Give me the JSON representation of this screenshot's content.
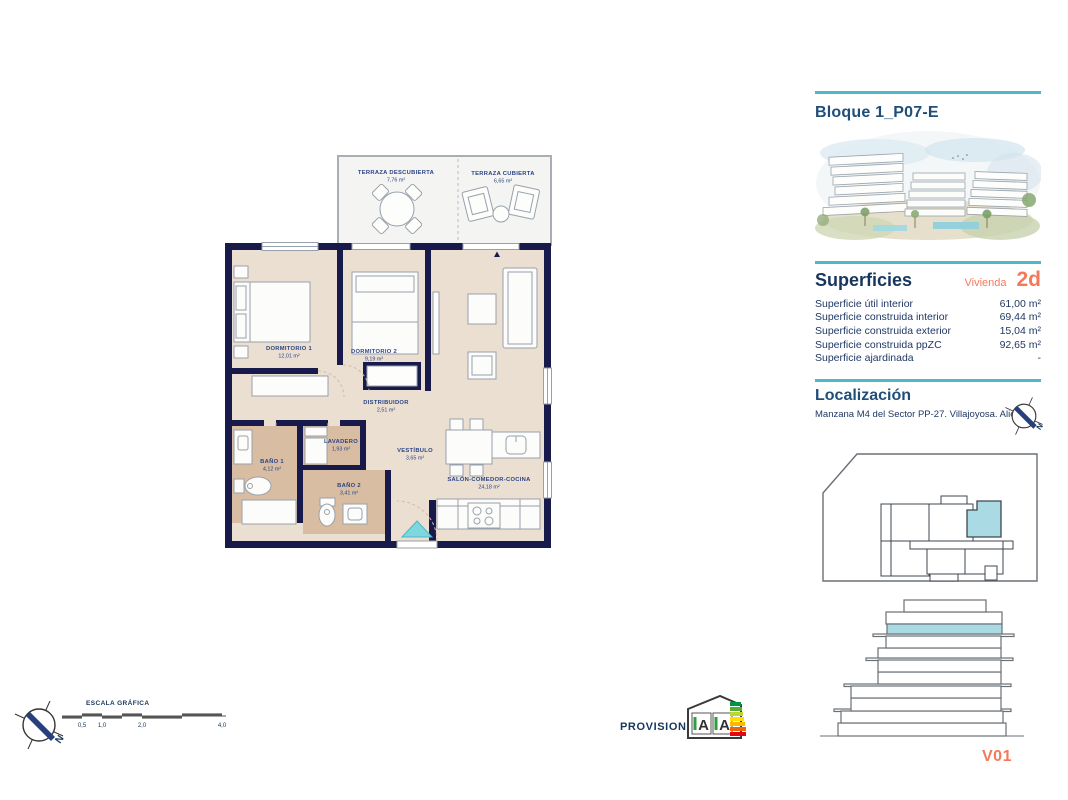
{
  "colors": {
    "teal": "#4cb9c6",
    "orange": "#f4795b",
    "navy_text": "#17365d",
    "wall_navy": "#181a4b",
    "floor_beige": "#ebdfd2",
    "floor_tan": "#d8bda2",
    "highlight_blue": "#aadbe4"
  },
  "header": {
    "title": "Bloque 1_P07-E"
  },
  "superficies": {
    "heading": "Superficies",
    "vivienda_label": "Vivienda",
    "vivienda_value": "2d",
    "rows": [
      {
        "label": "Superficie útil interior",
        "value": "61,00 m²"
      },
      {
        "label": "Superficie construida interior",
        "value": "69,44 m²"
      },
      {
        "label": "Superficie construida exterior",
        "value": "15,04 m²"
      },
      {
        "label": "Superficie construida ppZC",
        "value": "92,65 m²"
      },
      {
        "label": "Superficie ajardinada",
        "value": "-"
      }
    ]
  },
  "localizacion": {
    "heading": "Localización",
    "address": "Manzana M4 del Sector PP-27. Villajoyosa. Alicante"
  },
  "plan": {
    "rooms": [
      {
        "name": "TERRAZA DESCUBIERTA",
        "area": "7,76 m²"
      },
      {
        "name": "TERRAZA CUBIERTA",
        "area": "6,65 m²"
      },
      {
        "name": "DORMITORIO 1",
        "area": "12,01 m²"
      },
      {
        "name": "DORMITORIO 2",
        "area": "9,19 m²"
      },
      {
        "name": "DISTRIBUIDOR",
        "area": "2,51 m²"
      },
      {
        "name": "LAVADERO",
        "area": "1,93 m²"
      },
      {
        "name": "BAÑO 1",
        "area": "4,12 m²"
      },
      {
        "name": "BAÑO 2",
        "area": "3,41 m²"
      },
      {
        "name": "VESTÍBULO",
        "area": "3,65 m²"
      },
      {
        "name": "SALÓN-COMEDOR-COCINA",
        "area": "24,18 m²"
      }
    ]
  },
  "scale_bar": {
    "title": "ESCALA GRÁFICA",
    "ticks": [
      "0,5",
      "1,0",
      "2,0",
      "4,0"
    ]
  },
  "energy": {
    "rating": "A",
    "provisional": "PROVISIONAL"
  },
  "compass": {
    "north": "N"
  },
  "version": {
    "label": "V01"
  }
}
